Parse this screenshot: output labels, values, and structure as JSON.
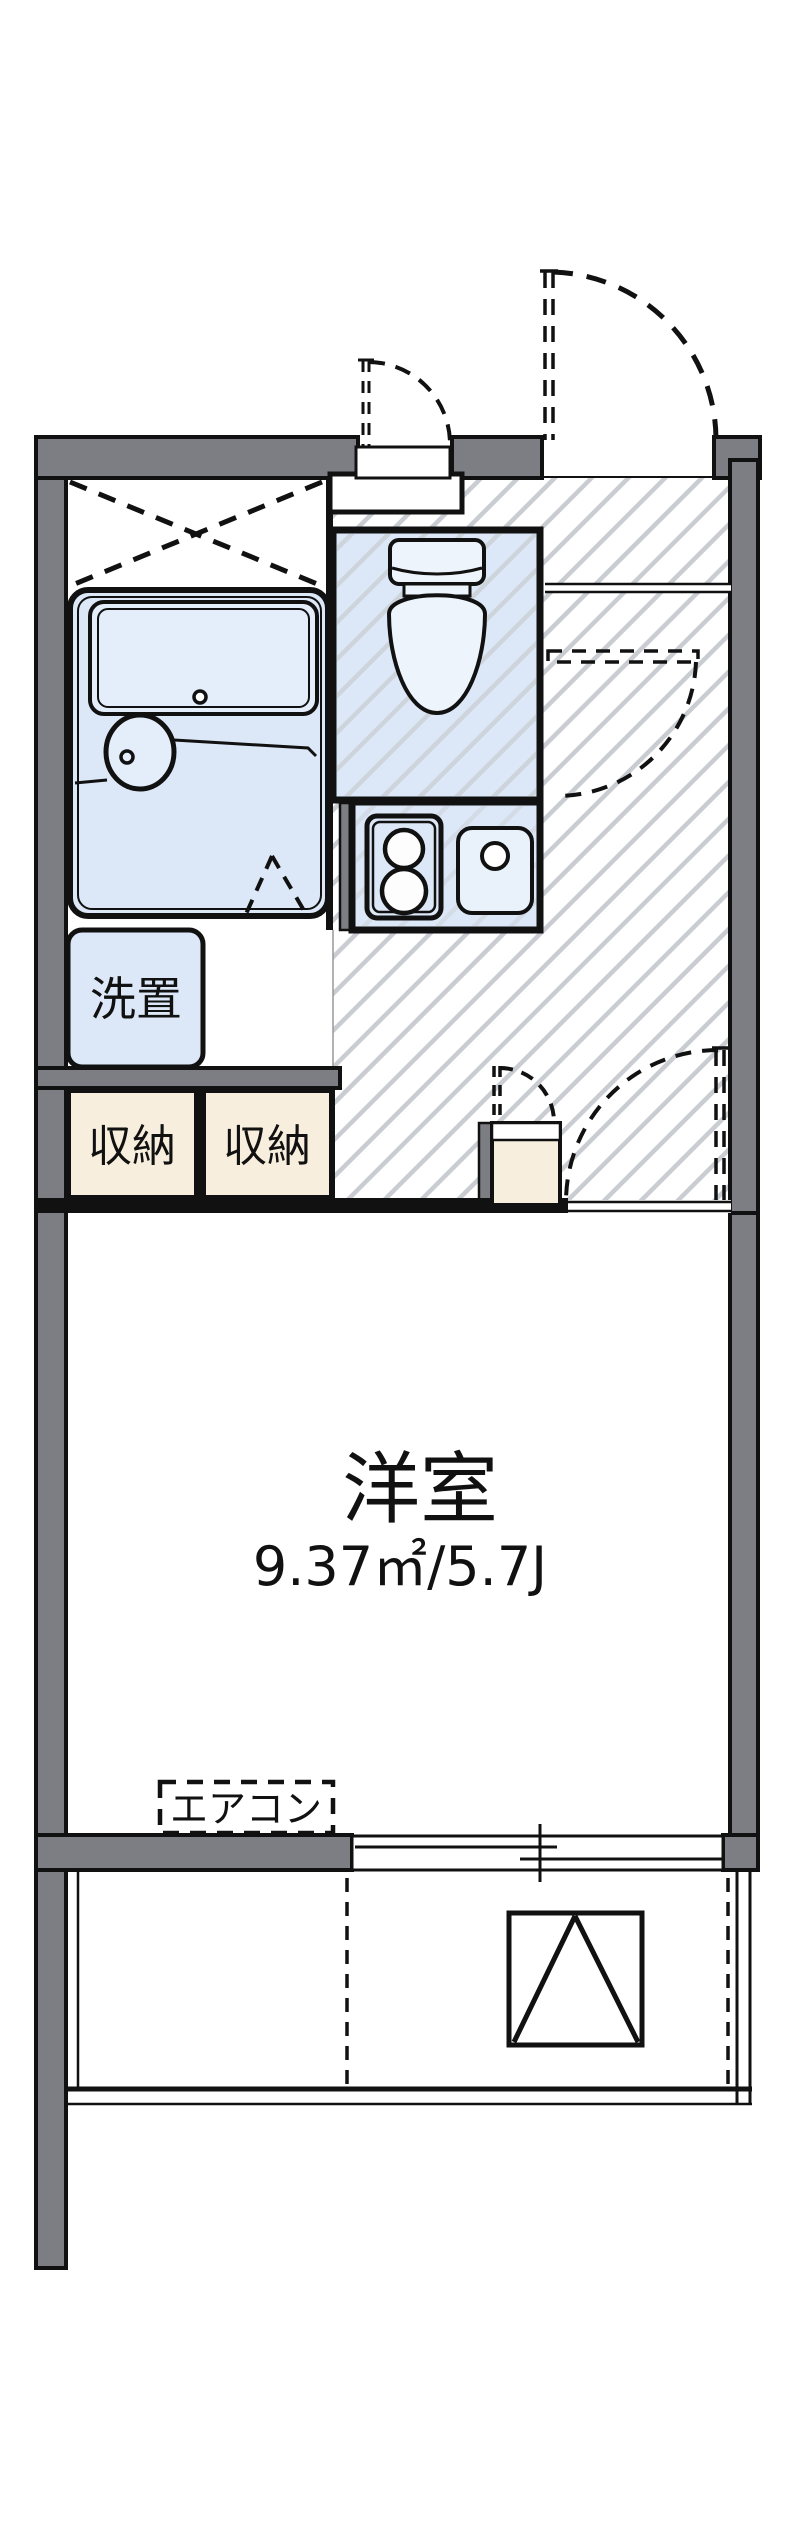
{
  "plan": {
    "type": "apartment-floor-plan",
    "labels": {
      "washer": "洗置",
      "storage_left": "収納",
      "storage_right": "収納",
      "room_name": "洋室",
      "room_area": "9.37㎡/5.7J",
      "aircon": "エアコン"
    },
    "rooms": [
      {
        "name": "洋室",
        "area_m2": "9.37㎡",
        "area_jo": "5.7J"
      },
      {
        "name": "ユニットバス"
      },
      {
        "name": "トイレ"
      },
      {
        "name": "キッチン"
      },
      {
        "name": "バルコニー"
      }
    ],
    "fixtures": [
      "bathtub-icon",
      "washbasin-icon",
      "toilet-icon",
      "stove-icon",
      "kitchen-sink-icon",
      "washer-space",
      "storage-closet",
      "storage-closet",
      "water-heater-box",
      "sliding-window",
      "evacuation-hatch-icon",
      "aircon-space",
      "entrance-door-swing",
      "niche-door-swing",
      "hall-door-swing",
      "room-door-swing",
      "heater-door-swing",
      "bath-folding-door",
      "crossed-ceiling-marker"
    ],
    "colors": {
      "wall_fill": "#7d7e84",
      "water_blue": "#dce8f7",
      "water_blue_light": "#e9f1fb",
      "storage_cream": "#f8eedd",
      "hatch_stripe": "#c9cdd2",
      "line_black": "#111111"
    }
  }
}
